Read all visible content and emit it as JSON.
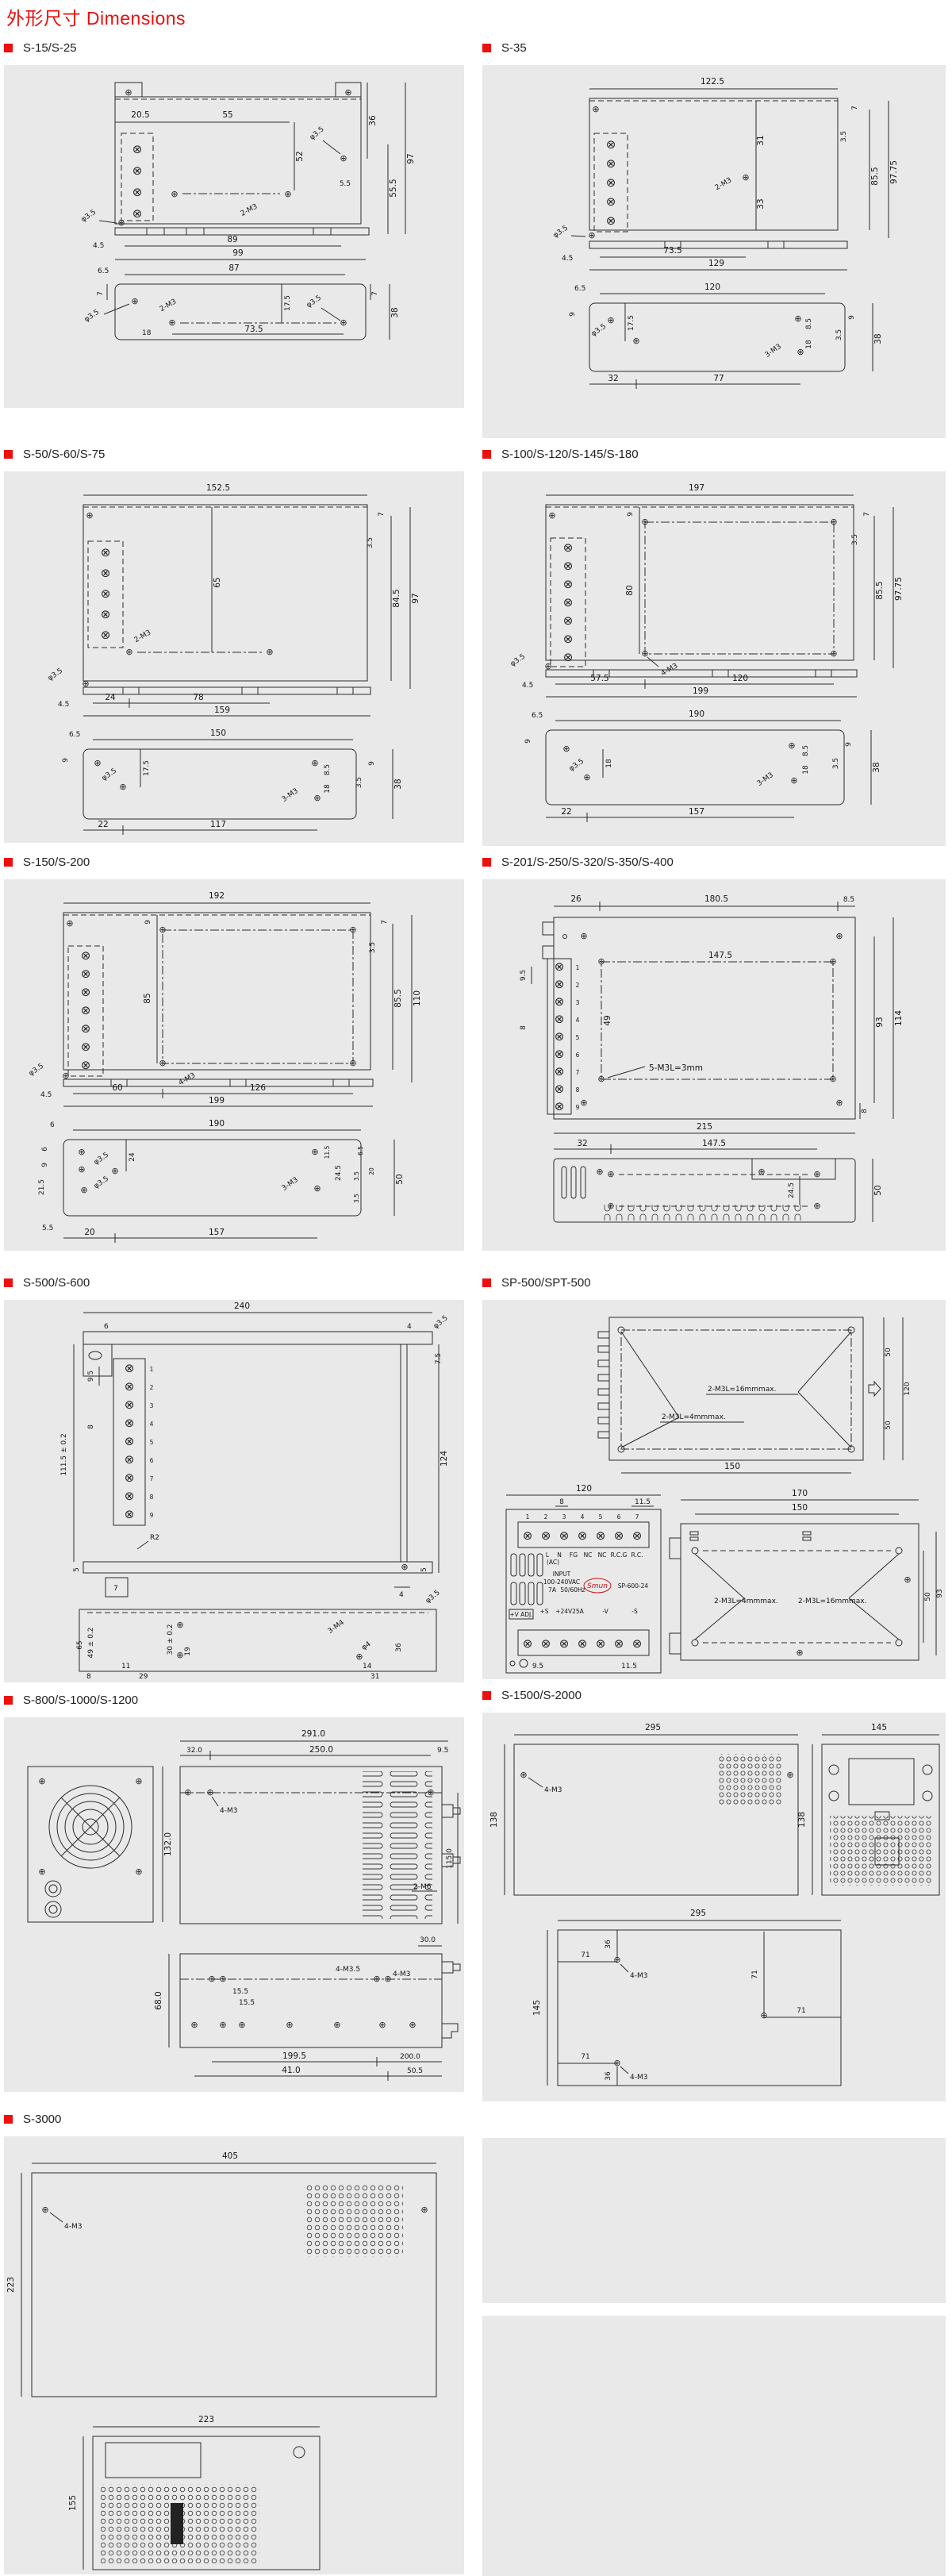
{
  "page": {
    "title": "外形尺寸 Dimensions",
    "accent_color": "#ee0f0f",
    "panel_bg": "#e9e9e9",
    "glyphs": {
      "terminal": "⊗",
      "screw": "⊕"
    }
  },
  "sections": [
    {
      "label": "S-15/S-25",
      "labels": [
        "20.5",
        "55",
        "36",
        "52",
        "φ3.5",
        "5.5",
        "97",
        "55.5",
        "2-M3",
        "φ3.5",
        "4.5",
        "89",
        "99",
        "6.5",
        "87",
        "7",
        "φ3.5",
        "2-M3",
        "18",
        "17.5",
        "73.5",
        "φ3.5",
        "7",
        "38"
      ]
    },
    {
      "label": "S-35",
      "labels": [
        "122.5",
        "7",
        "3.5",
        "31",
        "2-M3",
        "33",
        "85.5",
        "97.75",
        "φ3.5",
        "4.5",
        "73.5",
        "129",
        "6.5",
        "120",
        "9",
        "φ3.5",
        "17.5",
        "8.5",
        "18",
        "3-M3",
        "3.5",
        "9",
        "38",
        "32",
        "77"
      ]
    },
    {
      "label": "S-50/S-60/S-75",
      "labels": [
        "152.5",
        "7",
        "3.5",
        "65",
        "2-M3",
        "84.5",
        "97",
        "φ3.5",
        "4.5",
        "24",
        "78",
        "159",
        "6.5",
        "150",
        "9",
        "φ3.5",
        "17.5",
        "8.5",
        "18",
        "3-M3",
        "3.5",
        "9",
        "38",
        "22",
        "117"
      ]
    },
    {
      "label": "S-100/S-120/S-145/S-180",
      "labels": [
        "197",
        "9",
        "7",
        "3.5",
        "80",
        "4-M3",
        "85.5",
        "97.75",
        "φ3.5",
        "4.5",
        "57.5",
        "120",
        "199",
        "6.5",
        "190",
        "9",
        "φ3.5",
        "18",
        "8.5",
        "18",
        "3-M3",
        "3.5",
        "9",
        "38",
        "22",
        "157"
      ]
    },
    {
      "label": "S-150/S-200",
      "labels": [
        "192",
        "9",
        "7",
        "3.5",
        "85",
        "4-M3",
        "85.5",
        "110",
        "φ3.5",
        "4.5",
        "60",
        "126",
        "199",
        "6",
        "190",
        "6",
        "9",
        "21.5",
        "φ3.5",
        "φ3.5",
        "24",
        "3-M3",
        "24.5",
        "11.5",
        "6.5",
        "3.5",
        "20",
        "3.5",
        "50",
        "5.5",
        "20",
        "157"
      ]
    },
    {
      "label": "S-201/S-250/S-320/S-350/S-400",
      "labels": [
        "26",
        "180.5",
        "8.5",
        "147.5",
        "9.5",
        "8",
        "49",
        "5-M3L=3mm",
        "93",
        "114",
        "8",
        "215",
        "32",
        "147.5",
        "24.5",
        "50"
      ],
      "terminals": [
        "1",
        "2",
        "3",
        "4",
        "5",
        "6",
        "7",
        "8",
        "9"
      ]
    },
    {
      "label": "S-500/S-600",
      "labels": [
        "240",
        "6",
        "4",
        "φ3.5",
        "7.5",
        "9.5",
        "8",
        "111.5 ± 0.2",
        "124",
        "R2",
        "5",
        "7",
        "5",
        "4",
        "φ3.5",
        "49 ± 0.2",
        "65",
        "30 ± 0.2",
        "19",
        "3-M4",
        "φ4",
        "36",
        "11",
        "29",
        "14",
        "31",
        "8"
      ],
      "terminals": [
        "1",
        "2",
        "3",
        "4",
        "5",
        "6",
        "7",
        "8",
        "9"
      ]
    },
    {
      "label": "SP-500/SPT-500",
      "labels": [
        "2-M3L=16mmmax.",
        "2-M3L=4mmmax.",
        "50",
        "120",
        "50",
        "150",
        "120",
        "8",
        "11.5",
        "170",
        "150",
        "2-M3L=4mmmax.",
        "2-M3L=16mmmax.",
        "50",
        "93",
        "9.5",
        "11.5"
      ],
      "front": {
        "brand": "Smun",
        "model": "SP-600-24",
        "input1": "INPUT",
        "input2": "100-240VAC",
        "input3": "7A",
        "input4": "50/60Hz",
        "ac": "(AC)",
        "pins": [
          "L",
          "N",
          "FG",
          "NC",
          "NC",
          "R.C.G",
          "R.C."
        ],
        "vadj": "+V ADJ.",
        "out_s_plus": "+S",
        "out_main": "+24V25A",
        "out_v_minus": "-V",
        "out_s_minus": "-S",
        "terms": [
          "1",
          "2",
          "3",
          "4",
          "5",
          "6",
          "7"
        ]
      }
    },
    {
      "label": "S-800/S-1000/S-1200",
      "labels": [
        "291.0",
        "32.0",
        "250.0",
        "9.5",
        "4-M3",
        "132.0",
        "115.0",
        "2-M6",
        "30.0",
        "68.0",
        "15.5",
        "15.5",
        "4-M3.5",
        "4-M3",
        "199.5",
        "200.0",
        "41.0",
        "50.5"
      ]
    },
    {
      "label": "S-1500/S-2000",
      "labels": [
        "295",
        "4-M3",
        "138",
        "145",
        "138",
        "295",
        "36",
        "71",
        "4-M3",
        "145",
        "71",
        "71",
        "71",
        "36",
        "4-M3"
      ]
    },
    {
      "label": "S-3000",
      "labels": [
        "405",
        "4-M3",
        "223",
        "223",
        "155"
      ]
    }
  ]
}
